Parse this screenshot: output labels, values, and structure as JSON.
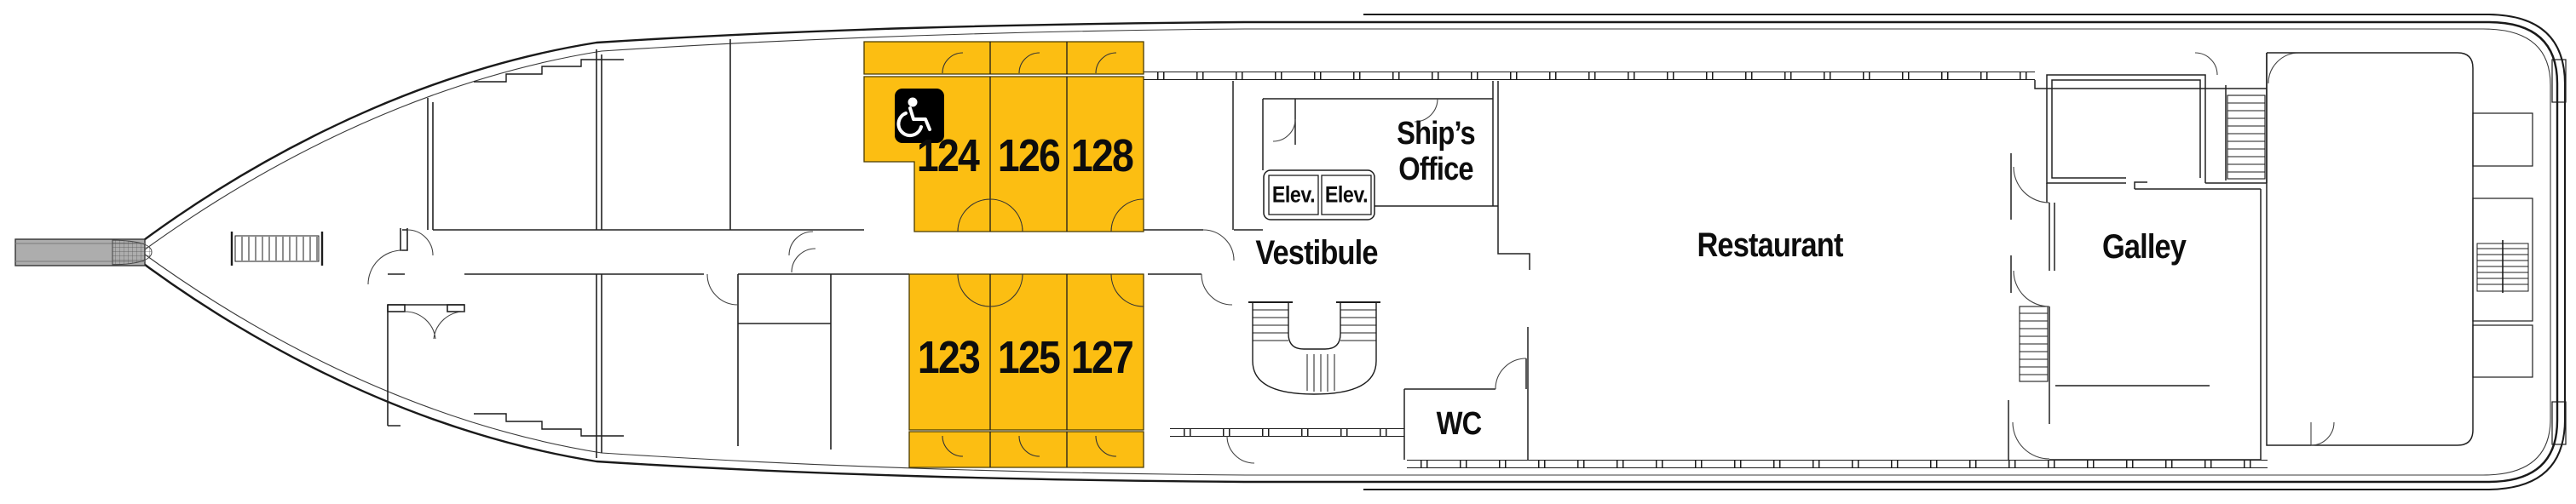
{
  "deck_plan": {
    "colors": {
      "cabin_fill": "#FCBE12",
      "hull_line": "#1a1a1a",
      "gangway_fill": "#ADADAD",
      "accessible_badge": "#000000"
    },
    "cabins": [
      {
        "number": "124",
        "accessible": true
      },
      {
        "number": "126",
        "accessible": false
      },
      {
        "number": "128",
        "accessible": false
      },
      {
        "number": "123",
        "accessible": false
      },
      {
        "number": "125",
        "accessible": false
      },
      {
        "number": "127",
        "accessible": false
      }
    ],
    "rooms": {
      "vestibule": "Vestibule",
      "ships_office_line1": "Ship’s",
      "ships_office_line2": "Office",
      "restaurant": "Restaurant",
      "galley": "Galley",
      "wc": "WC",
      "elevator_1": "Elev.",
      "elevator_2": "Elev."
    },
    "icons": {
      "wheelchair": "wheelchair-accessible-icon"
    }
  }
}
